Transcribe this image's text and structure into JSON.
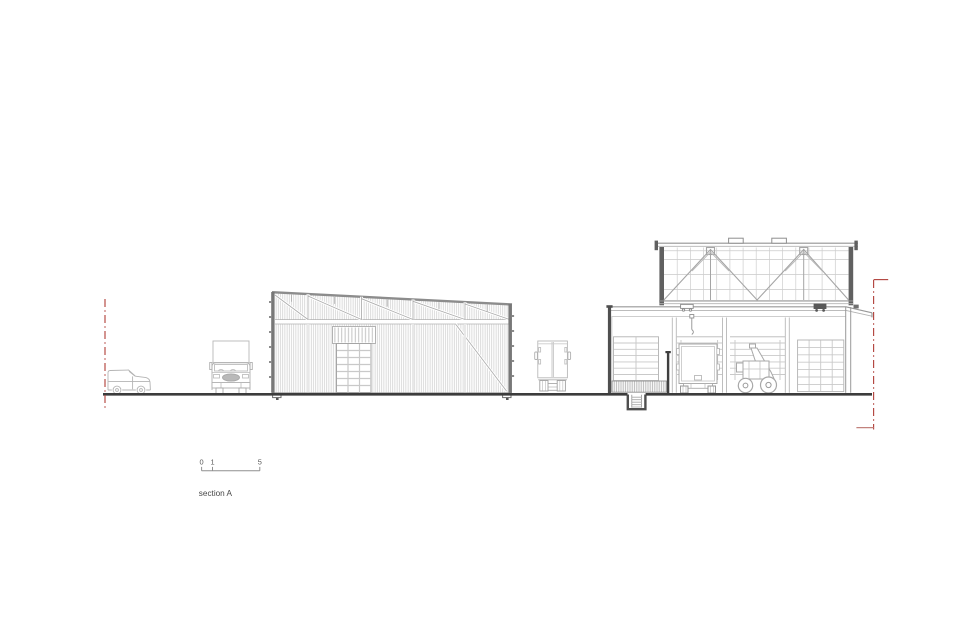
{
  "page": {
    "background_color": "#ffffff"
  },
  "colors": {
    "line_light": "#c8c8c8",
    "line_medium": "#9a9a9a",
    "line_dark": "#4f4f4f",
    "ground_line": "#3c3c3c",
    "boundary_red": "#b3453f",
    "boundary_red_soft": "#c2827d",
    "text": "#4a4a4a"
  },
  "scale_bar": {
    "tick_labels": [
      "0",
      "1",
      "5"
    ]
  },
  "caption": {
    "text": "section A"
  },
  "drawing": {
    "objects": [
      "site-boundary-line-left",
      "delivery-van-side-view",
      "truck-front-view",
      "warehouse-elevation",
      "roof-truss",
      "sectional-door",
      "box-truck-rear-view",
      "workshop-cross-section",
      "clerestory-truss-volume",
      "skylights",
      "roller-doors",
      "box-truck-in-bay",
      "telehandler-in-bay",
      "chain-hoist",
      "loading-dock-hatch",
      "stair-pit",
      "canopy",
      "ground-line",
      "site-boundary-line-right",
      "scale-bar"
    ]
  }
}
